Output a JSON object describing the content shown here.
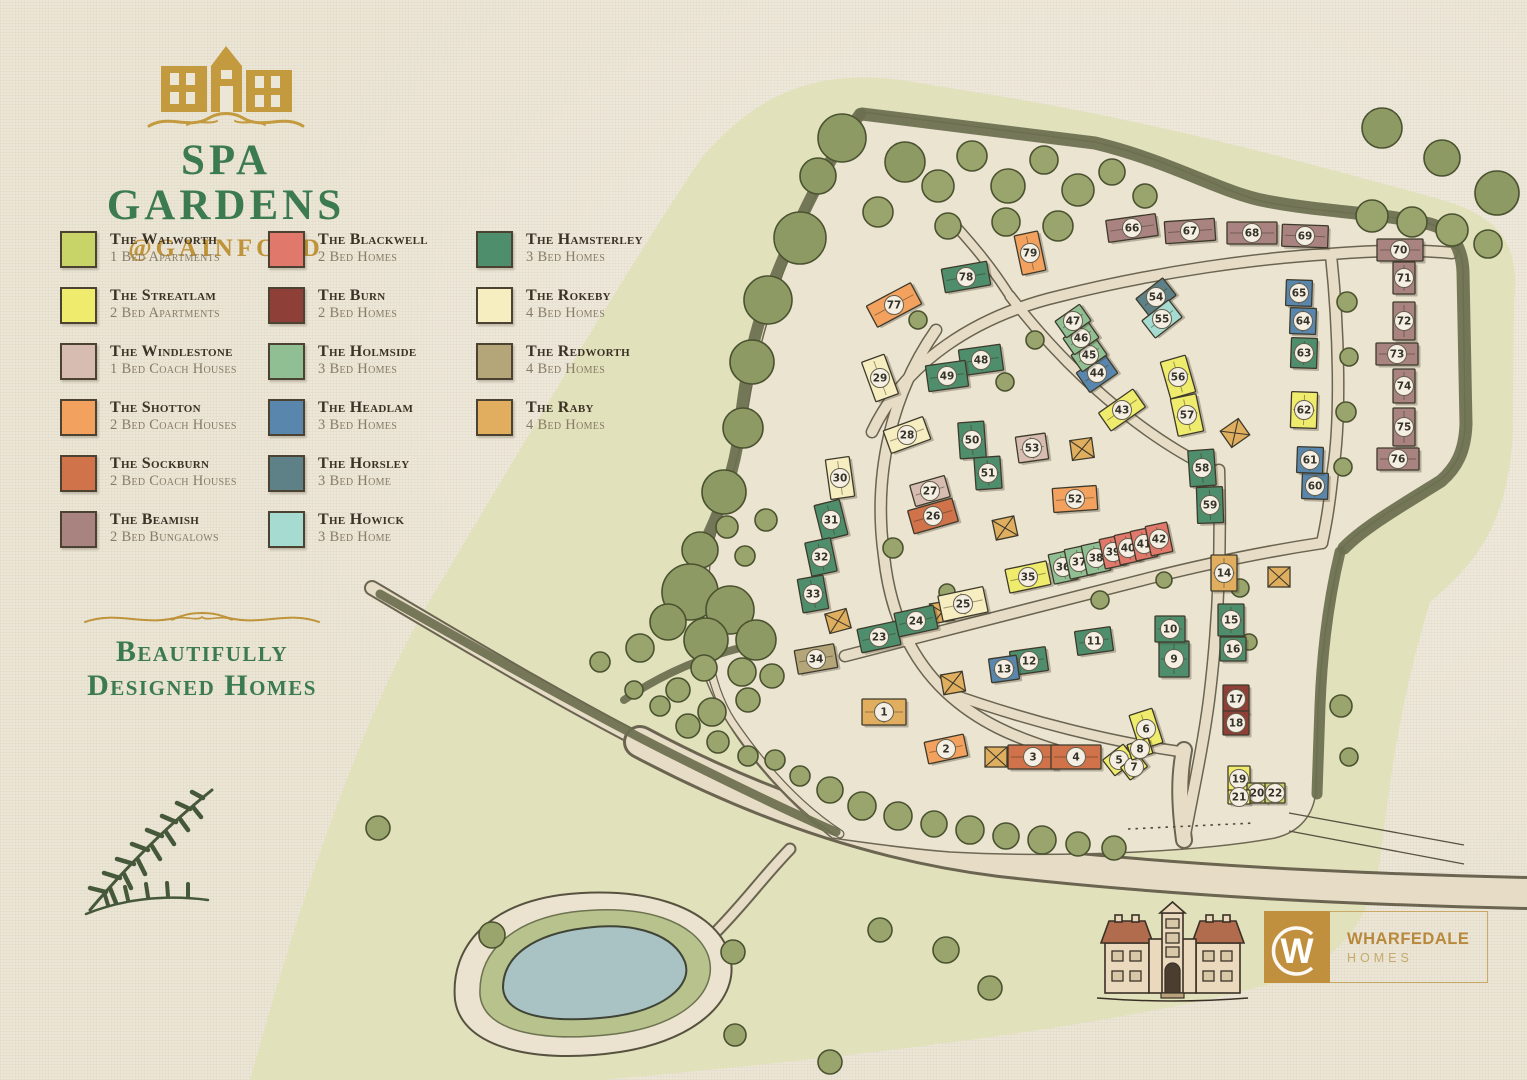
{
  "branding": {
    "title": "SPA GARDENS",
    "subtitle": "@GAINFORD",
    "tagline_line1": "Beautifully",
    "tagline_line2": "Designed Homes"
  },
  "developer": {
    "name": "WHARFEDALE",
    "division": "HOMES",
    "monogram": "W"
  },
  "colors": {
    "paper": "#ece6d6",
    "green_wash": "#e1e1bc",
    "accent_gold": "#bf9339",
    "accent_green": "#3c7a50",
    "water": "#a9c2c3",
    "hedge": "#6c6f50"
  },
  "house_types": {
    "walworth": {
      "name": "The Walworth",
      "desc": "1 Bed Apartments",
      "color": "#c9d468"
    },
    "streatlam": {
      "name": "The Streatlam",
      "desc": "2 Bed Apartments",
      "color": "#efec6d"
    },
    "windlestone": {
      "name": "The Windlestone",
      "desc": "1 Bed Coach Houses",
      "color": "#d7bcb2"
    },
    "shotton": {
      "name": "The Shotton",
      "desc": "2 Bed Coach Houses",
      "color": "#f2a25e"
    },
    "sockburn": {
      "name": "The Sockburn",
      "desc": "2 Bed Coach Houses",
      "color": "#d0724a"
    },
    "beamish": {
      "name": "The Beamish",
      "desc": "2 Bed Bungalows",
      "color": "#a88380"
    },
    "blackwell": {
      "name": "The Blackwell",
      "desc": "2 Bed Homes",
      "color": "#e0796c"
    },
    "burn": {
      "name": "The Burn",
      "desc": "2 Bed Homes",
      "color": "#8e4038"
    },
    "holmside": {
      "name": "The Holmside",
      "desc": "3 Bed Homes",
      "color": "#90bf94"
    },
    "headlam": {
      "name": "The Headlam",
      "desc": "3 Bed Homes",
      "color": "#5886ac"
    },
    "horsley": {
      "name": "The Horsley",
      "desc": "3 Bed Home",
      "color": "#5d8186"
    },
    "howick": {
      "name": "The Howick",
      "desc": "3 Bed Home",
      "color": "#a5dbd1"
    },
    "hamsterley": {
      "name": "The Hamsterley",
      "desc": "3 Bed Homes",
      "color": "#4e8e6d"
    },
    "rokeby": {
      "name": "The Rokeby",
      "desc": "4 Bed Homes",
      "color": "#f6edc1"
    },
    "redworth": {
      "name": "The Redworth",
      "desc": "4 Bed Homes",
      "color": "#b4a678"
    },
    "raby": {
      "name": "The Raby",
      "desc": "4 Bed Homes",
      "color": "#e0ae5e"
    }
  },
  "legend_columns": [
    [
      "walworth",
      "streatlam",
      "windlestone",
      "shotton",
      "sockburn",
      "beamish"
    ],
    [
      "blackwell",
      "burn",
      "holmside",
      "headlam",
      "horsley",
      "howick"
    ],
    [
      "hamsterley",
      "rokeby",
      "redworth",
      "raby"
    ]
  ],
  "map": {
    "plots": [
      {
        "n": 1,
        "x": 884,
        "y": 712,
        "w": 44,
        "h": 26,
        "r": 0,
        "t": "raby"
      },
      {
        "n": 2,
        "x": 946,
        "y": 749,
        "w": 40,
        "h": 22,
        "r": -12,
        "t": "shotton"
      },
      {
        "n": 3,
        "x": 1033,
        "y": 757,
        "w": 50,
        "h": 24,
        "r": 0,
        "t": "sockburn"
      },
      {
        "n": 4,
        "x": 1076,
        "y": 757,
        "w": 50,
        "h": 24,
        "r": 0,
        "t": "sockburn"
      },
      {
        "n": 5,
        "x": 1119,
        "y": 760,
        "w": 26,
        "h": 20,
        "r": -38,
        "t": "streatlam"
      },
      {
        "n": 6,
        "x": 1146,
        "y": 729,
        "w": 24,
        "h": 36,
        "r": -18,
        "t": "streatlam"
      },
      {
        "n": 7,
        "x": 1134,
        "y": 767,
        "w": 22,
        "h": 16,
        "r": -38,
        "t": "streatlam"
      },
      {
        "n": 8,
        "x": 1140,
        "y": 749,
        "w": 22,
        "h": 16,
        "r": -18,
        "t": "streatlam"
      },
      {
        "n": 9,
        "x": 1174,
        "y": 659,
        "w": 30,
        "h": 36,
        "r": 0,
        "t": "hamsterley"
      },
      {
        "n": 10,
        "x": 1170,
        "y": 629,
        "w": 30,
        "h": 26,
        "r": 0,
        "t": "hamsterley"
      },
      {
        "n": 11,
        "x": 1094,
        "y": 641,
        "w": 36,
        "h": 24,
        "r": -8,
        "t": "hamsterley"
      },
      {
        "n": 12,
        "x": 1029,
        "y": 661,
        "w": 36,
        "h": 24,
        "r": -8,
        "t": "hamsterley"
      },
      {
        "n": 13,
        "x": 1004,
        "y": 669,
        "w": 28,
        "h": 24,
        "r": -8,
        "t": "headlam"
      },
      {
        "n": 14,
        "x": 1224,
        "y": 573,
        "w": 26,
        "h": 36,
        "r": 0,
        "t": "raby"
      },
      {
        "n": 15,
        "x": 1231,
        "y": 620,
        "w": 26,
        "h": 32,
        "r": 0,
        "t": "hamsterley"
      },
      {
        "n": 16,
        "x": 1233,
        "y": 649,
        "w": 26,
        "h": 24,
        "r": 0,
        "t": "hamsterley"
      },
      {
        "n": 17,
        "x": 1236,
        "y": 699,
        "w": 26,
        "h": 28,
        "r": 0,
        "t": "burn"
      },
      {
        "n": 18,
        "x": 1236,
        "y": 723,
        "w": 26,
        "h": 24,
        "r": 0,
        "t": "burn"
      },
      {
        "n": 19,
        "x": 1239,
        "y": 779,
        "w": 22,
        "h": 26,
        "r": 0,
        "t": "streatlam"
      },
      {
        "n": 20,
        "x": 1257,
        "y": 793,
        "w": 20,
        "h": 20,
        "r": 0,
        "t": "walworth"
      },
      {
        "n": 21,
        "x": 1239,
        "y": 797,
        "w": 22,
        "h": 14,
        "r": 0,
        "t": "streatlam"
      },
      {
        "n": 22,
        "x": 1275,
        "y": 793,
        "w": 20,
        "h": 20,
        "r": 0,
        "t": "walworth"
      },
      {
        "n": 23,
        "x": 879,
        "y": 637,
        "w": 40,
        "h": 24,
        "r": -12,
        "t": "hamsterley"
      },
      {
        "n": 24,
        "x": 916,
        "y": 621,
        "w": 40,
        "h": 24,
        "r": -12,
        "t": "hamsterley"
      },
      {
        "n": 25,
        "x": 963,
        "y": 604,
        "w": 46,
        "h": 26,
        "r": -12,
        "t": "rokeby"
      },
      {
        "n": 26,
        "x": 933,
        "y": 516,
        "w": 46,
        "h": 24,
        "r": -16,
        "t": "sockburn"
      },
      {
        "n": 27,
        "x": 930,
        "y": 491,
        "w": 36,
        "h": 22,
        "r": -16,
        "t": "windlestone"
      },
      {
        "n": 28,
        "x": 907,
        "y": 435,
        "w": 42,
        "h": 24,
        "r": -20,
        "t": "rokeby"
      },
      {
        "n": 29,
        "x": 880,
        "y": 378,
        "w": 24,
        "h": 42,
        "r": -20,
        "t": "rokeby"
      },
      {
        "n": 30,
        "x": 840,
        "y": 478,
        "w": 24,
        "h": 40,
        "r": -8,
        "t": "rokeby"
      },
      {
        "n": 31,
        "x": 831,
        "y": 520,
        "w": 26,
        "h": 36,
        "r": -14,
        "t": "hamsterley"
      },
      {
        "n": 32,
        "x": 821,
        "y": 557,
        "w": 26,
        "h": 34,
        "r": -12,
        "t": "hamsterley"
      },
      {
        "n": 33,
        "x": 813,
        "y": 594,
        "w": 26,
        "h": 34,
        "r": -10,
        "t": "hamsterley"
      },
      {
        "n": 34,
        "x": 816,
        "y": 659,
        "w": 40,
        "h": 24,
        "r": -10,
        "t": "redworth"
      },
      {
        "n": 35,
        "x": 1028,
        "y": 577,
        "w": 42,
        "h": 24,
        "r": -12,
        "t": "streatlam"
      },
      {
        "n": 36,
        "x": 1063,
        "y": 567,
        "w": 24,
        "h": 30,
        "r": -12,
        "t": "holmside"
      },
      {
        "n": 37,
        "x": 1079,
        "y": 562,
        "w": 24,
        "h": 30,
        "r": -12,
        "t": "holmside"
      },
      {
        "n": 38,
        "x": 1096,
        "y": 558,
        "w": 24,
        "h": 30,
        "r": -12,
        "t": "holmside"
      },
      {
        "n": 39,
        "x": 1113,
        "y": 552,
        "w": 22,
        "h": 30,
        "r": -12,
        "t": "blackwell"
      },
      {
        "n": 40,
        "x": 1128,
        "y": 548,
        "w": 22,
        "h": 30,
        "r": -12,
        "t": "blackwell"
      },
      {
        "n": 41,
        "x": 1144,
        "y": 544,
        "w": 22,
        "h": 30,
        "r": -12,
        "t": "blackwell"
      },
      {
        "n": 42,
        "x": 1159,
        "y": 539,
        "w": 22,
        "h": 30,
        "r": -12,
        "t": "blackwell"
      },
      {
        "n": 43,
        "x": 1122,
        "y": 410,
        "w": 42,
        "h": 22,
        "r": -35,
        "t": "streatlam"
      },
      {
        "n": 44,
        "x": 1097,
        "y": 373,
        "w": 34,
        "h": 24,
        "r": -35,
        "t": "headlam"
      },
      {
        "n": 45,
        "x": 1089,
        "y": 355,
        "w": 30,
        "h": 20,
        "r": -35,
        "t": "holmside"
      },
      {
        "n": 46,
        "x": 1081,
        "y": 338,
        "w": 30,
        "h": 20,
        "r": -35,
        "t": "holmside"
      },
      {
        "n": 47,
        "x": 1073,
        "y": 321,
        "w": 30,
        "h": 20,
        "r": -35,
        "t": "holmside"
      },
      {
        "n": 48,
        "x": 981,
        "y": 360,
        "w": 42,
        "h": 26,
        "r": -8,
        "t": "hamsterley"
      },
      {
        "n": 49,
        "x": 947,
        "y": 376,
        "w": 40,
        "h": 26,
        "r": -8,
        "t": "hamsterley"
      },
      {
        "n": 50,
        "x": 972,
        "y": 440,
        "w": 26,
        "h": 36,
        "r": -4,
        "t": "hamsterley"
      },
      {
        "n": 51,
        "x": 988,
        "y": 473,
        "w": 26,
        "h": 32,
        "r": -4,
        "t": "hamsterley"
      },
      {
        "n": 52,
        "x": 1075,
        "y": 499,
        "w": 44,
        "h": 24,
        "r": -4,
        "t": "shotton"
      },
      {
        "n": 53,
        "x": 1032,
        "y": 448,
        "w": 30,
        "h": 26,
        "r": -8,
        "t": "windlestone"
      },
      {
        "n": 54,
        "x": 1156,
        "y": 297,
        "w": 34,
        "h": 22,
        "r": -38,
        "t": "horsley"
      },
      {
        "n": 55,
        "x": 1162,
        "y": 319,
        "w": 34,
        "h": 22,
        "r": -38,
        "t": "howick"
      },
      {
        "n": 56,
        "x": 1178,
        "y": 377,
        "w": 26,
        "h": 38,
        "r": -16,
        "t": "streatlam"
      },
      {
        "n": 57,
        "x": 1187,
        "y": 415,
        "w": 26,
        "h": 38,
        "r": -12,
        "t": "streatlam"
      },
      {
        "n": 58,
        "x": 1202,
        "y": 468,
        "w": 26,
        "h": 36,
        "r": -4,
        "t": "hamsterley"
      },
      {
        "n": 59,
        "x": 1210,
        "y": 505,
        "w": 26,
        "h": 36,
        "r": -2,
        "t": "hamsterley"
      },
      {
        "n": 60,
        "x": 1315,
        "y": 486,
        "w": 26,
        "h": 26,
        "r": 2,
        "t": "headlam"
      },
      {
        "n": 61,
        "x": 1310,
        "y": 460,
        "w": 26,
        "h": 26,
        "r": 2,
        "t": "headlam"
      },
      {
        "n": 62,
        "x": 1304,
        "y": 410,
        "w": 26,
        "h": 36,
        "r": 2,
        "t": "streatlam"
      },
      {
        "n": 63,
        "x": 1304,
        "y": 353,
        "w": 26,
        "h": 30,
        "r": 2,
        "t": "hamsterley"
      },
      {
        "n": 64,
        "x": 1303,
        "y": 321,
        "w": 26,
        "h": 26,
        "r": 2,
        "t": "headlam"
      },
      {
        "n": 65,
        "x": 1299,
        "y": 293,
        "w": 26,
        "h": 26,
        "r": 2,
        "t": "headlam"
      },
      {
        "n": 66,
        "x": 1132,
        "y": 228,
        "w": 50,
        "h": 22,
        "r": -8,
        "t": "beamish"
      },
      {
        "n": 67,
        "x": 1190,
        "y": 231,
        "w": 50,
        "h": 22,
        "r": -4,
        "t": "beamish"
      },
      {
        "n": 68,
        "x": 1252,
        "y": 233,
        "w": 50,
        "h": 22,
        "r": 0,
        "t": "beamish"
      },
      {
        "n": 69,
        "x": 1305,
        "y": 236,
        "w": 46,
        "h": 22,
        "r": 2,
        "t": "beamish"
      },
      {
        "n": 70,
        "x": 1400,
        "y": 250,
        "w": 46,
        "h": 22,
        "r": 0,
        "t": "beamish"
      },
      {
        "n": 71,
        "x": 1404,
        "y": 278,
        "w": 22,
        "h": 32,
        "r": 0,
        "t": "beamish"
      },
      {
        "n": 72,
        "x": 1404,
        "y": 321,
        "w": 22,
        "h": 38,
        "r": 0,
        "t": "beamish"
      },
      {
        "n": 73,
        "x": 1397,
        "y": 354,
        "w": 42,
        "h": 22,
        "r": 0,
        "t": "beamish"
      },
      {
        "n": 74,
        "x": 1404,
        "y": 386,
        "w": 22,
        "h": 34,
        "r": 0,
        "t": "beamish"
      },
      {
        "n": 75,
        "x": 1404,
        "y": 427,
        "w": 22,
        "h": 38,
        "r": 0,
        "t": "beamish"
      },
      {
        "n": 76,
        "x": 1398,
        "y": 459,
        "w": 42,
        "h": 22,
        "r": 0,
        "t": "beamish"
      },
      {
        "n": 77,
        "x": 894,
        "y": 305,
        "w": 50,
        "h": 24,
        "r": -28,
        "t": "shotton"
      },
      {
        "n": 78,
        "x": 966,
        "y": 277,
        "w": 46,
        "h": 24,
        "r": -10,
        "t": "hamsterley"
      },
      {
        "n": 79,
        "x": 1030,
        "y": 253,
        "w": 24,
        "h": 40,
        "r": -12,
        "t": "shotton"
      }
    ],
    "garages": [
      {
        "x": 953,
        "y": 683,
        "r": -10
      },
      {
        "x": 942,
        "y": 612,
        "r": -10
      },
      {
        "x": 838,
        "y": 621,
        "r": -15
      },
      {
        "x": 1005,
        "y": 528,
        "r": -12
      },
      {
        "x": 1082,
        "y": 449,
        "r": -8
      },
      {
        "x": 1279,
        "y": 577,
        "r": 0
      },
      {
        "x": 1235,
        "y": 433,
        "r": -35
      },
      {
        "x": 996,
        "y": 757,
        "r": 0
      }
    ],
    "trees": [
      [
        800,
        238,
        26
      ],
      [
        768,
        300,
        24
      ],
      [
        752,
        362,
        22
      ],
      [
        743,
        428,
        20
      ],
      [
        724,
        492,
        22
      ],
      [
        700,
        550,
        18
      ],
      [
        766,
        520,
        11
      ],
      [
        745,
        556,
        10
      ],
      [
        842,
        138,
        24
      ],
      [
        818,
        176,
        18
      ],
      [
        905,
        162,
        20
      ],
      [
        938,
        186,
        16
      ],
      [
        972,
        156,
        15
      ],
      [
        1008,
        186,
        17
      ],
      [
        1044,
        160,
        14
      ],
      [
        1078,
        190,
        16
      ],
      [
        1112,
        172,
        13
      ],
      [
        1006,
        222,
        14
      ],
      [
        948,
        226,
        13
      ],
      [
        1058,
        226,
        15
      ],
      [
        878,
        212,
        15
      ],
      [
        1145,
        196,
        12
      ],
      [
        1372,
        216,
        16
      ],
      [
        1412,
        222,
        15
      ],
      [
        1452,
        230,
        16
      ],
      [
        1488,
        244,
        14
      ],
      [
        1382,
        128,
        20
      ],
      [
        1442,
        158,
        18
      ],
      [
        1497,
        193,
        22
      ],
      [
        1347,
        302,
        10
      ],
      [
        1349,
        357,
        9
      ],
      [
        1346,
        412,
        10
      ],
      [
        1343,
        467,
        9
      ],
      [
        1341,
        706,
        11
      ],
      [
        1349,
        757,
        9
      ],
      [
        600,
        662,
        10
      ],
      [
        640,
        648,
        14
      ],
      [
        678,
        690,
        12
      ],
      [
        712,
        712,
        14
      ],
      [
        748,
        700,
        12
      ],
      [
        727,
        527,
        11
      ],
      [
        690,
        592,
        28
      ],
      [
        730,
        610,
        24
      ],
      [
        756,
        640,
        20
      ],
      [
        706,
        640,
        22
      ],
      [
        668,
        622,
        18
      ],
      [
        742,
        672,
        14
      ],
      [
        704,
        668,
        13
      ],
      [
        772,
        676,
        12
      ],
      [
        688,
        726,
        12
      ],
      [
        718,
        742,
        11
      ],
      [
        748,
        756,
        10
      ],
      [
        660,
        706,
        10
      ],
      [
        634,
        690,
        9
      ],
      [
        775,
        760,
        10
      ],
      [
        800,
        776,
        10
      ],
      [
        830,
        790,
        13
      ],
      [
        862,
        806,
        14
      ],
      [
        898,
        816,
        14
      ],
      [
        934,
        824,
        13
      ],
      [
        970,
        830,
        14
      ],
      [
        1006,
        836,
        13
      ],
      [
        1042,
        840,
        14
      ],
      [
        1078,
        844,
        12
      ],
      [
        1114,
        848,
        12
      ],
      [
        492,
        935,
        13
      ],
      [
        733,
        952,
        12
      ],
      [
        880,
        930,
        12
      ],
      [
        946,
        950,
        13
      ],
      [
        990,
        988,
        12
      ],
      [
        830,
        1062,
        12
      ],
      [
        735,
        1035,
        11
      ],
      [
        378,
        828,
        12
      ],
      [
        918,
        320,
        9
      ],
      [
        1035,
        340,
        9
      ],
      [
        1005,
        382,
        9
      ],
      [
        893,
        548,
        10
      ],
      [
        947,
        592,
        8
      ],
      [
        1100,
        600,
        9
      ],
      [
        1164,
        580,
        8
      ],
      [
        1240,
        588,
        9
      ],
      [
        1249,
        642,
        8
      ]
    ]
  }
}
